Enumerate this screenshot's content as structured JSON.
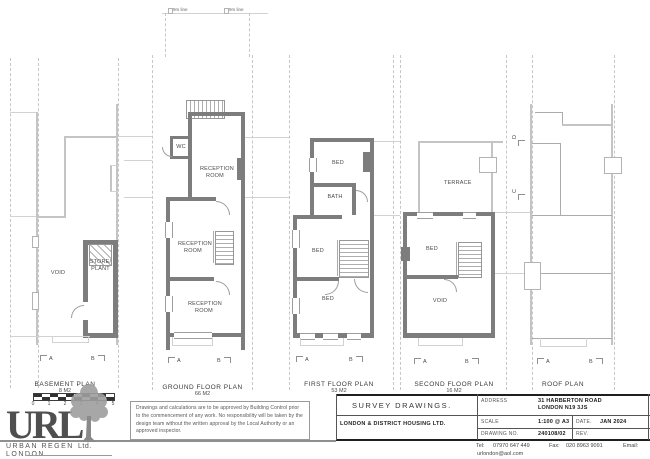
{
  "site": {
    "line_label_left": "9m line",
    "line_label_right": "9m line"
  },
  "plans": {
    "basement": {
      "title": "BASEMENT PLAN",
      "area": "8 M2",
      "room_void": "VOID",
      "room_store": "STORE/\nPLANT",
      "marker_a": "A",
      "marker_b": "B"
    },
    "ground": {
      "title": "GROUND FLOOR PLAN",
      "area": "66 M2",
      "room_wc": "WC",
      "room_reception_rear": "RECEPTION\nROOM",
      "room_reception_mid": "RECEPTION\nROOM",
      "room_reception_front": "RECEPTION\nROOM",
      "marker_a": "A",
      "marker_b": "B"
    },
    "first": {
      "title": "FIRST FLOOR PLAN",
      "area": "53 M2",
      "room_bed_rear": "BED",
      "room_bath": "BATH",
      "room_bed_mid": "BED",
      "room_bed_front": "BED",
      "marker_a": "A",
      "marker_b": "B"
    },
    "second": {
      "title": "SECOND FLOOR PLAN",
      "area": "16 M2",
      "room_terrace": "TERRACE",
      "room_bed": "BED",
      "room_void": "VOID",
      "marker_a": "A",
      "marker_b": "B"
    },
    "roof": {
      "title": "ROOF PLAN",
      "marker_a": "A",
      "marker_b": "B",
      "marker_c": "C",
      "marker_d": "D"
    }
  },
  "scalebar": {
    "ticks": [
      "0",
      "1",
      "2",
      "3",
      "4",
      "5"
    ]
  },
  "logo": {
    "initials": "URL",
    "line1": "URBAN  REGEN",
    "line2": "LONDON",
    "suffix": "Ltd."
  },
  "disclaimer": "Drawings and calculations are to be approved by Building Control prior to the commencement of any work. No responsibility will be taken by the design team without the written approval by the Local Authority or an approved inspector.",
  "titleblock": {
    "title": "SURVEY  DRAWINGS.",
    "client": "LONDON & DISTRICT HOUSING LTD.",
    "address_label": "ADDRESS",
    "address_line1": "31 HARBERTON ROAD",
    "address_line2": "LONDON  N19 3JS",
    "scale_label": "SCALE",
    "scale_value": "1:100 @ A3",
    "date_label": "DATE.",
    "date_value": "JAN 2024",
    "drawing_no_label": "DRAWING  NO.",
    "drawing_no_value": "240108/02",
    "rev_label": "REV.",
    "tel_label": "Tel:",
    "tel_value": "07970 647 449",
    "fax_label": "Fax:",
    "fax_value": "020 8963 9091",
    "email_label": "Email:",
    "email_value": "urlondon@aol.com"
  }
}
